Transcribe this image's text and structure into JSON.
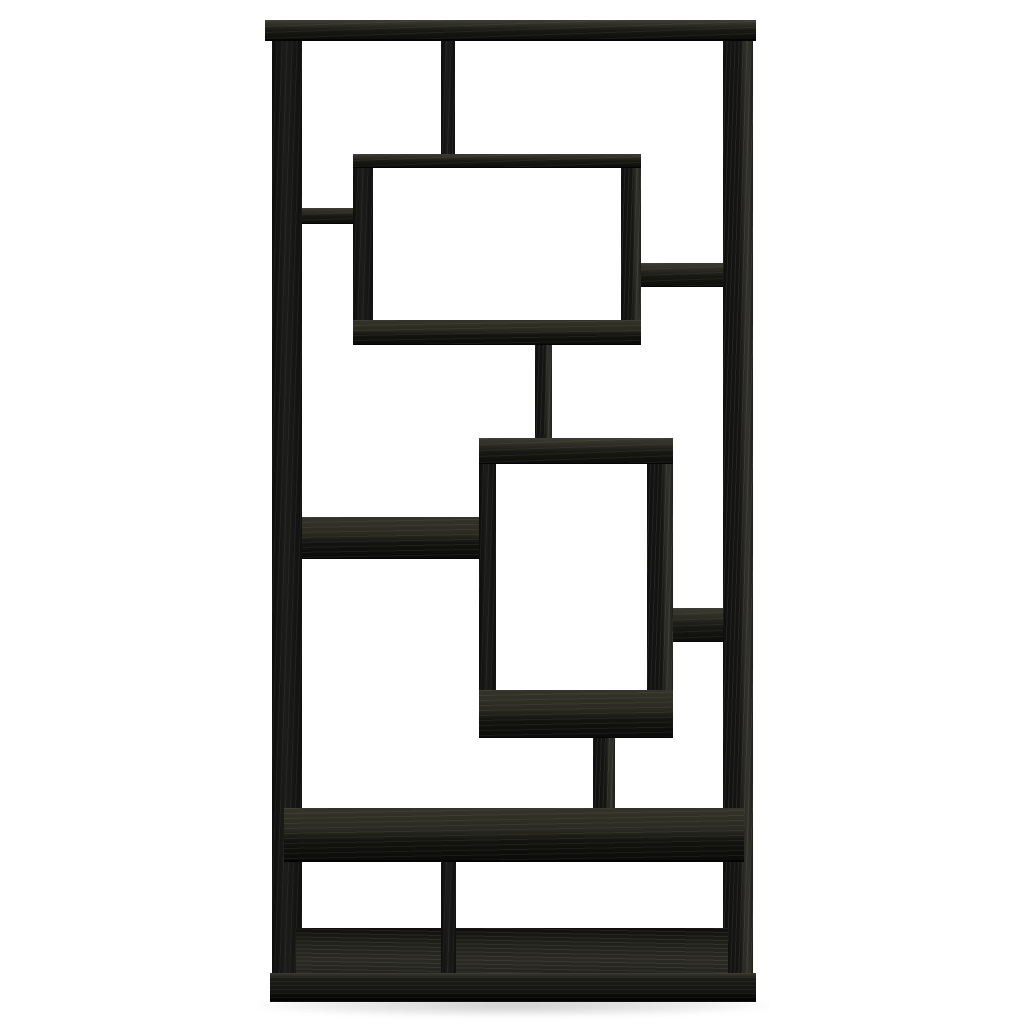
{
  "image": {
    "type": "product photo",
    "subject": "Black woodgrain geometric etagere bookcase with asymmetrical interlocking open shelves on a white background",
    "finish": "black oak woodgrain",
    "background": "#ffffff"
  },
  "palette": {
    "board_face": "#141412",
    "board_top_face": "#3a3a31",
    "board_side_face": "#30302a",
    "edge_dark": "#050505",
    "floor_shadow": "rgba(0,0,0,0.20)"
  },
  "parts": {
    "labels": [
      "top-board",
      "left-post",
      "right-post",
      "top-center-divider",
      "upper-display-cube",
      "shelf-upper-left",
      "shelf-upper-right",
      "center-connector",
      "lower-display-cube",
      "shelf-middle-left",
      "shelf-lower-right",
      "lower-connector",
      "long-shelf",
      "bottom-divider",
      "bottom-floor-shelf",
      "plinth-base",
      "floor-shadow"
    ]
  }
}
